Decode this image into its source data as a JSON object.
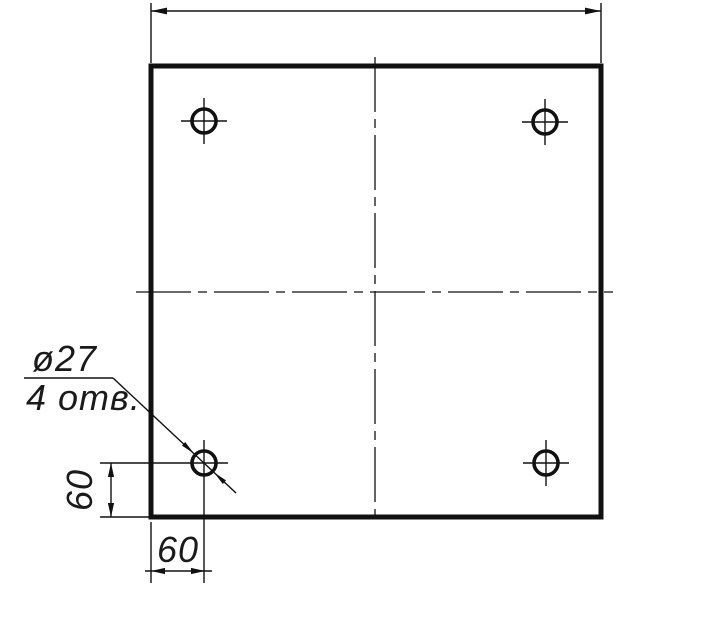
{
  "note": {
    "line1": "ø27",
    "line2": "4 отв."
  },
  "dimensions": {
    "left_vertical": "60",
    "bottom_horizontal": "60"
  },
  "semantics": {
    "hole_count": 4,
    "hole_diameter_label": "ø27",
    "hole_offset_from_left_edge": "60",
    "hole_offset_from_bottom_edge": "60"
  },
  "style": {
    "line_color": "#111111",
    "background": "#ffffff"
  }
}
